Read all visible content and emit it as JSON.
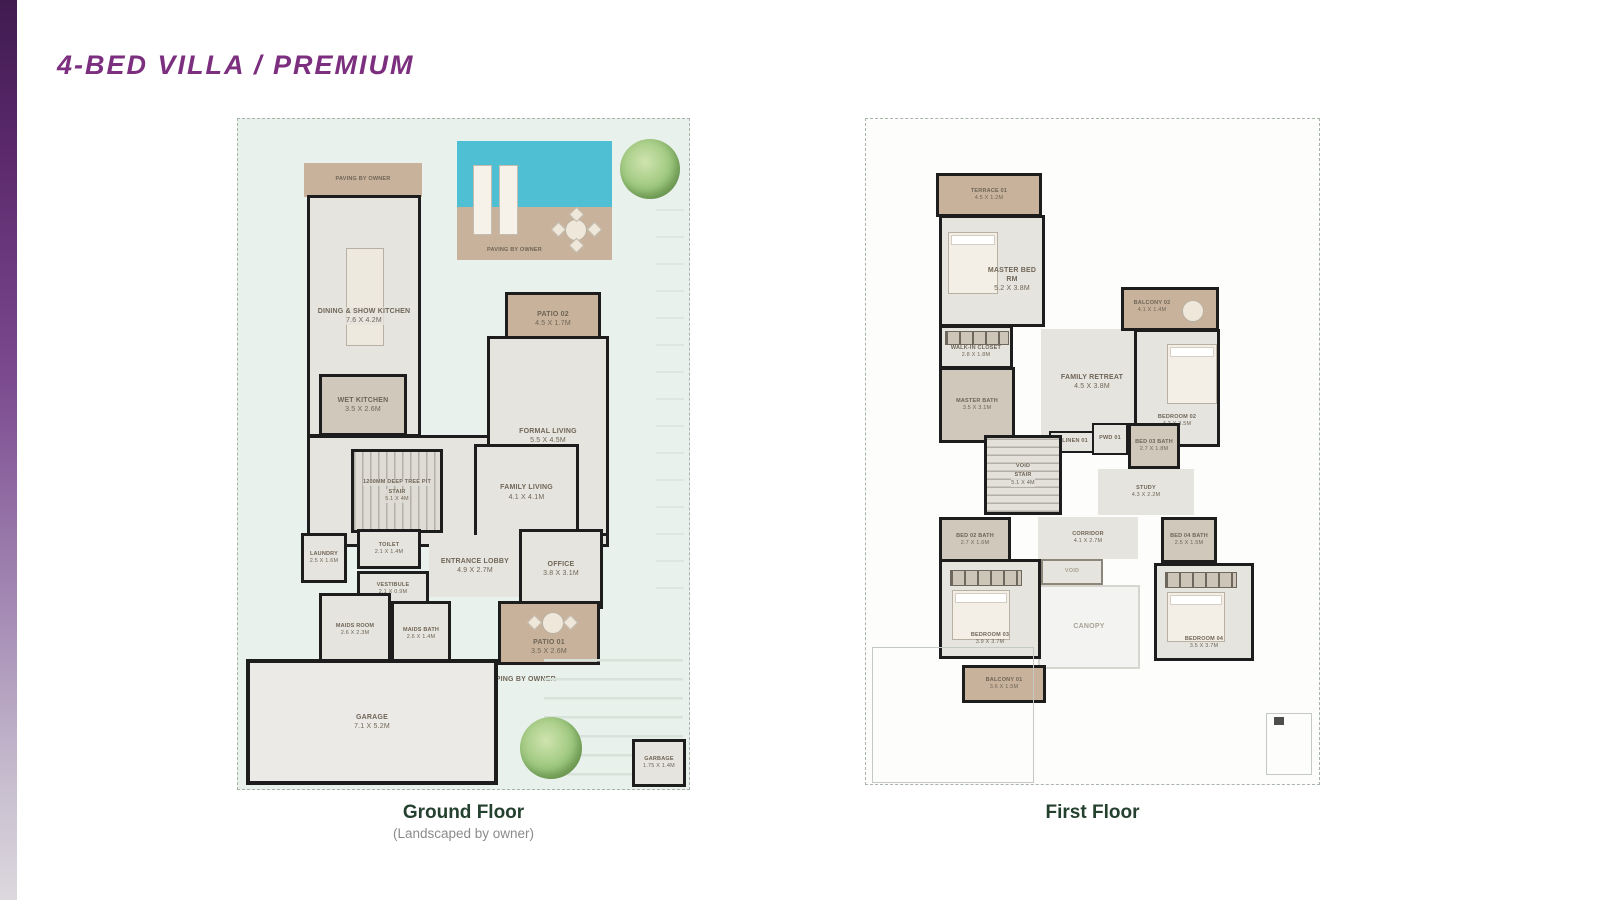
{
  "palette": {
    "accent_purple": "#7b2f7e",
    "plot_mint": "#e9f1ec",
    "room_gray": "#e6e4de",
    "paving_tan": "#c8b29c",
    "pool_blue": "#4fc0d4",
    "wall_black": "#1d1d1d",
    "caption_green": "#24402e",
    "subcaption_gray": "#8b8b8b"
  },
  "title": "4-BED VILLA / PREMIUM",
  "ground_floor": {
    "caption": "Ground Floor",
    "subcaption": "(Landscaped by owner)",
    "rooms": {
      "paving_top": {
        "name": "PAVING BY OWNER",
        "dims": ""
      },
      "dining": {
        "name": "DINING & SHOW KITCHEN",
        "dims": "7.6 X 4.2M"
      },
      "paving_pool": {
        "name": "PAVING BY OWNER",
        "dims": ""
      },
      "patio02": {
        "name": "PATIO 02",
        "dims": "4.5 X 1.7M"
      },
      "formal_living": {
        "name": "FORMAL LIVING",
        "dims": "5.5 X 4.5M"
      },
      "wet_kitchen": {
        "name": "WET KITCHEN",
        "dims": "3.5 X 2.6M"
      },
      "tree_pit": {
        "name": "1200MM DEEP TREE PIT",
        "dims": ""
      },
      "stair": {
        "name": "STAIR",
        "dims": "5.1 X 4M"
      },
      "family_living": {
        "name": "FAMILY LIVING",
        "dims": "4.1 X 4.1M"
      },
      "laundry": {
        "name": "LAUNDRY",
        "dims": "2.5 X 1.6M"
      },
      "toilet": {
        "name": "TOILET",
        "dims": "2.1 X 1.4M"
      },
      "vestibule": {
        "name": "VESTIBULE",
        "dims": "2.1 X 0.9M"
      },
      "entrance_lobby": {
        "name": "ENTRANCE LOBBY",
        "dims": "4.9 X 2.7M"
      },
      "office": {
        "name": "OFFICE",
        "dims": "3.8 X 3.1M"
      },
      "maids_room": {
        "name": "MAIDS ROOM",
        "dims": "2.6 X 2.3M"
      },
      "maids_bath": {
        "name": "MAIDS BATH",
        "dims": "2.6 X 1.4M"
      },
      "patio01": {
        "name": "PATIO 01",
        "dims": "3.5 X 2.6M"
      },
      "landscaping": {
        "name": "LANDSCAPING BY OWNER",
        "dims": ""
      },
      "garage": {
        "name": "GARAGE",
        "dims": "7.1 X 5.2M"
      },
      "garbage": {
        "name": "GARBAGE",
        "dims": "1.75 X 1.4M"
      }
    }
  },
  "first_floor": {
    "caption": "First Floor",
    "rooms": {
      "terrace01": {
        "name": "TERRACE 01",
        "dims": "4.5 X 1.2M"
      },
      "master_bed": {
        "name": "MASTER BED RM",
        "dims": "5.2 X 3.8M"
      },
      "walkin_closet": {
        "name": "WALK-IN CLOSET",
        "dims": "2.8 X 1.8M"
      },
      "master_bath": {
        "name": "MASTER BATH",
        "dims": "3.5 X 3.1M"
      },
      "family_retreat": {
        "name": "FAMILY RETREAT",
        "dims": "4.5 X 3.8M"
      },
      "balcony02": {
        "name": "BALCONY 02",
        "dims": "4.1 X 1.4M"
      },
      "bedroom02": {
        "name": "BEDROOM 02",
        "dims": "4.2 X 3.5M"
      },
      "linen": {
        "name": "LINEN 01",
        "dims": "1.4 X 0.5M"
      },
      "void_stair_void": {
        "name": "VOID",
        "dims": ""
      },
      "void_stair": {
        "name": "STAIR",
        "dims": "5.1 X 4M"
      },
      "pwd": {
        "name": "PWD 01",
        "dims": ""
      },
      "bed03_bath": {
        "name": "BED 03 BATH",
        "dims": "2.7 X 1.8M"
      },
      "study": {
        "name": "STUDY",
        "dims": "4.3 X 2.2M"
      },
      "bed02_bath": {
        "name": "BED 02 BATH",
        "dims": "2.7 X 1.6M"
      },
      "corridor": {
        "name": "CORRIDOR",
        "dims": "4.1 X 2.7M"
      },
      "void2": {
        "name": "VOID",
        "dims": ""
      },
      "canopy": {
        "name": "CANOPY",
        "dims": ""
      },
      "bedroom03": {
        "name": "BEDROOM 03",
        "dims": "3.9 X 3.7M"
      },
      "bed04_bath": {
        "name": "BED 04 BATH",
        "dims": "2.5 X 1.5M"
      },
      "bedroom04": {
        "name": "BEDROOM 04",
        "dims": "3.5 X 3.7M"
      },
      "balcony01": {
        "name": "BALCONY 01",
        "dims": "3.6 X 1.5M"
      }
    }
  }
}
